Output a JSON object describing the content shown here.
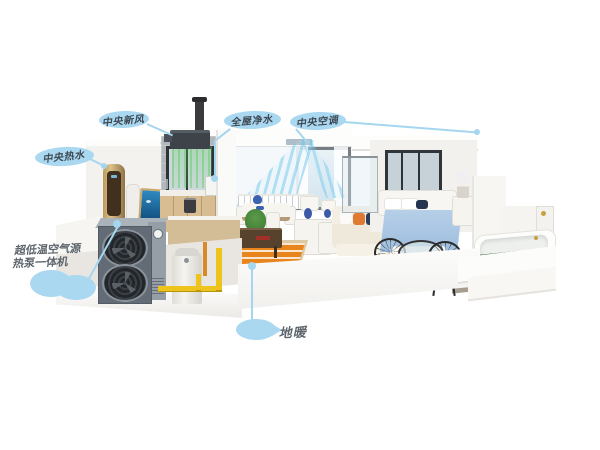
{
  "scene": {
    "description": "3D cutaway house illustration of an air-source heat pump whole-home system with callout labels",
    "background": "#ffffff"
  },
  "labels": {
    "fresh_air": "中央新风",
    "purified_water": "全屋净水",
    "central_ac": "中央空调",
    "hot_water": "中央热水",
    "heat_pump_line1": "超低温空气源",
    "heat_pump_line2": "热泵一体机",
    "floor_heating": "地暖"
  },
  "colors": {
    "callout_bubble": "#a9d8f0",
    "callout_text": "#3f4852",
    "leader_line": "#a5d6ef",
    "heat_pump_body": "#6b747e",
    "pipe_yellow": "#eec41c",
    "floor_coil_orange": "#e8851c",
    "airflow_cool": "#8fd0ee",
    "airflow_fresh": "#62c462",
    "bed_blue": "#a9c4e4",
    "roses_red": "#c22838"
  }
}
